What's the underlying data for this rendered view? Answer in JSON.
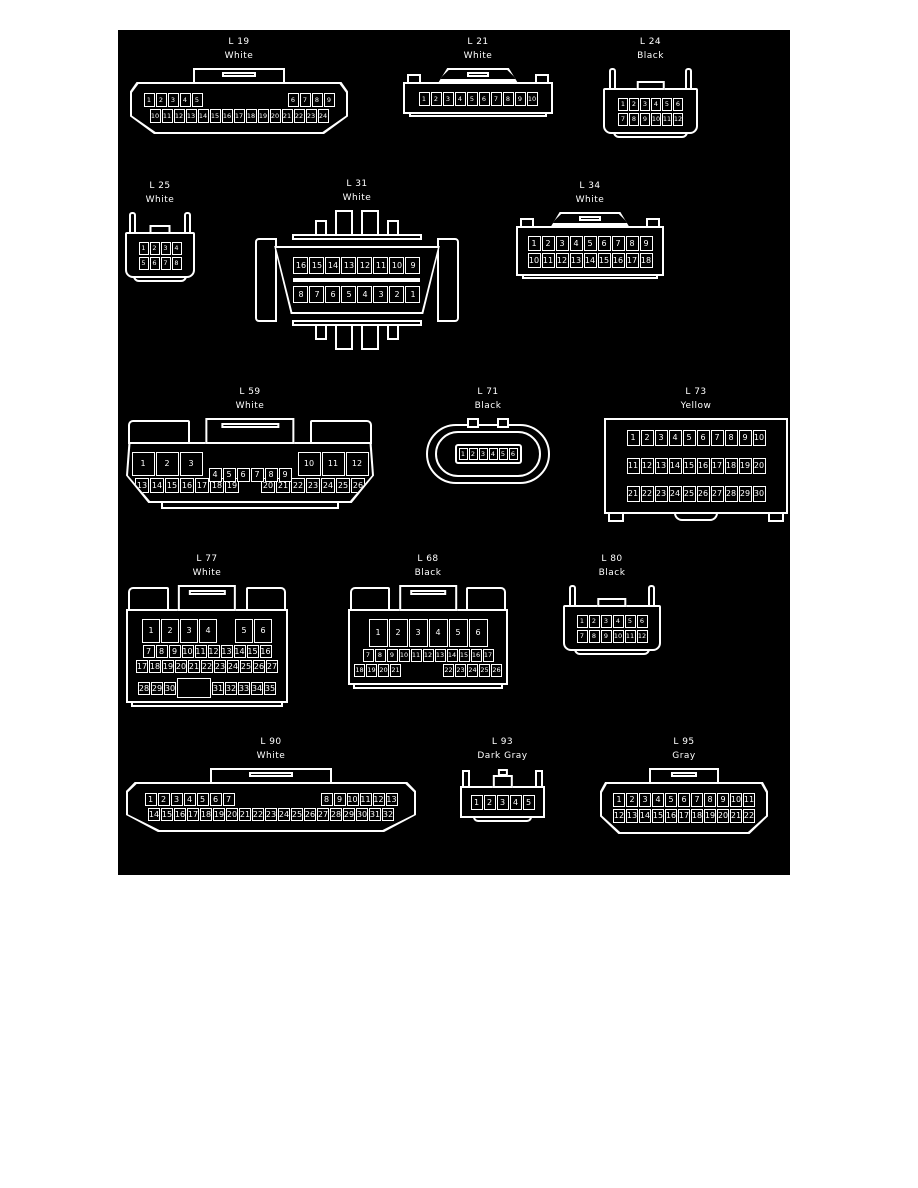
{
  "page": {
    "background": "#ffffff",
    "panel_bg": "#000000",
    "line_color": "#ffffff"
  },
  "connectors": [
    {
      "id": "L 19",
      "color": "White",
      "type": "trap-tab",
      "x": 12,
      "y": 8,
      "w": 218,
      "cell": {
        "w": 11,
        "h": 14
      },
      "rows": [
        {
          "cells": [
            "1",
            "2",
            "3",
            "4",
            "5",
            {
              "gap": 83
            },
            "6",
            "7",
            "8",
            "9"
          ]
        },
        {
          "cells": [
            "10",
            "11",
            "12",
            "13",
            "14",
            "15",
            "16",
            "17",
            "18",
            "19",
            "20",
            "21",
            "22",
            "23",
            "24"
          ]
        }
      ]
    },
    {
      "id": "L 21",
      "color": "White",
      "type": "crown",
      "x": 285,
      "y": 8,
      "w": 150,
      "cell": {
        "w": 11,
        "h": 14
      },
      "rows": [
        {
          "cells": [
            "1",
            "2",
            "3",
            "4",
            "5",
            "6",
            "7",
            "8",
            "9",
            "10"
          ]
        }
      ]
    },
    {
      "id": "L 24",
      "color": "Black",
      "type": "prong",
      "x": 485,
      "y": 8,
      "w": 95,
      "cell": {
        "w": 10,
        "h": 13
      },
      "rows": [
        {
          "cells": [
            "1",
            "2",
            "3",
            "4",
            "5",
            "6"
          ]
        },
        {
          "cells": [
            "7",
            "8",
            "9",
            "10",
            "11",
            "12"
          ]
        }
      ]
    },
    {
      "id": "L 25",
      "color": "White",
      "type": "prong",
      "x": 7,
      "y": 152,
      "w": 70,
      "cell": {
        "w": 10,
        "h": 13
      },
      "rows": [
        {
          "cells": [
            "1",
            "2",
            "3",
            "4"
          ]
        },
        {
          "cells": [
            "5",
            "6",
            "7",
            "8"
          ]
        }
      ]
    },
    {
      "id": "L 31",
      "color": "White",
      "type": "obd",
      "x": 130,
      "y": 150,
      "w": 218,
      "cell": {
        "w": 15,
        "h": 17
      },
      "divider": true,
      "rows": [
        {
          "cells": [
            "16",
            "15",
            "14",
            "13",
            "12",
            "11",
            "10",
            "9"
          ]
        },
        {
          "cells": [
            "8",
            "7",
            "6",
            "5",
            "4",
            "3",
            "2",
            "1"
          ]
        }
      ]
    },
    {
      "id": "L 34",
      "color": "White",
      "type": "crown",
      "x": 398,
      "y": 152,
      "w": 148,
      "cell": {
        "w": 13,
        "h": 15
      },
      "rows": [
        {
          "cells": [
            "1",
            "2",
            "3",
            "4",
            "5",
            "6",
            "7",
            "8",
            "9"
          ]
        },
        {
          "cells": [
            "10",
            "11",
            "12",
            "13",
            "14",
            "15",
            "16",
            "17",
            "18"
          ]
        }
      ]
    },
    {
      "id": "L 59",
      "color": "White",
      "type": "shoulders-trap",
      "x": 8,
      "y": 358,
      "w": 248,
      "cell": {
        "w": 14,
        "h": 15
      },
      "rows": [
        {
          "cells": [
            {
              "n": "1",
              "w": 23,
              "h": 24
            },
            {
              "n": "2",
              "w": 23,
              "h": 24
            },
            {
              "n": "3",
              "w": 23,
              "h": 24
            },
            {
              "gap": 4
            },
            {
              "n": "4",
              "w": 13,
              "h": 14,
              "dy": 6
            },
            {
              "n": "5",
              "w": 13,
              "h": 14,
              "dy": 6
            },
            {
              "n": "6",
              "w": 13,
              "h": 14,
              "dy": 6
            },
            {
              "n": "7",
              "w": 13,
              "h": 14,
              "dy": 6
            },
            {
              "n": "8",
              "w": 13,
              "h": 14,
              "dy": 6
            },
            {
              "n": "9",
              "w": 13,
              "h": 14,
              "dy": 6
            },
            {
              "gap": 4
            },
            {
              "n": "10",
              "w": 23,
              "h": 24
            },
            {
              "n": "11",
              "w": 23,
              "h": 24
            },
            {
              "n": "12",
              "w": 23,
              "h": 24
            }
          ]
        },
        {
          "cells": [
            "13",
            "14",
            "15",
            "16",
            "17",
            "18",
            "19",
            {
              "gap": 20
            },
            "20",
            "21",
            "22",
            "23",
            "24",
            "25",
            "26"
          ]
        }
      ]
    },
    {
      "id": "L 71",
      "color": "Black",
      "type": "oval",
      "x": 308,
      "y": 358,
      "w": 124,
      "cell": {
        "w": 9,
        "h": 12
      },
      "rows": [
        {
          "cells": [
            "1",
            "2",
            "3",
            "4",
            "5",
            "6"
          ]
        }
      ]
    },
    {
      "id": "L 73",
      "color": "Yellow",
      "type": "rect-feet",
      "x": 486,
      "y": 358,
      "w": 184,
      "cell": {
        "w": 13,
        "h": 16
      },
      "row_gap": 12,
      "rows": [
        {
          "cells": [
            "1",
            "2",
            "3",
            "4",
            "5",
            "6",
            "7",
            "8",
            "9",
            "10"
          ]
        },
        {
          "cells": [
            "11",
            "12",
            "13",
            "14",
            "15",
            "16",
            "17",
            "18",
            "19",
            "20"
          ]
        },
        {
          "cells": [
            "21",
            "22",
            "23",
            "24",
            "25",
            "26",
            "27",
            "28",
            "29",
            "30"
          ]
        }
      ]
    },
    {
      "id": "L 77",
      "color": "White",
      "type": "shoulders",
      "x": 8,
      "y": 525,
      "w": 162,
      "cell": {
        "w": 12,
        "h": 13
      },
      "rows": [
        {
          "cells": [
            {
              "n": "1",
              "w": 18,
              "h": 24
            },
            {
              "n": "2",
              "w": 18,
              "h": 24
            },
            {
              "n": "3",
              "w": 18,
              "h": 24
            },
            {
              "n": "4",
              "w": 18,
              "h": 24
            },
            {
              "gap": 16
            },
            {
              "n": "5",
              "w": 18,
              "h": 24
            },
            {
              "n": "6",
              "w": 18,
              "h": 24
            }
          ]
        },
        {
          "cells": [
            "7",
            "8",
            "9",
            "10",
            "11",
            "12",
            "13",
            "14",
            "15",
            "16"
          ]
        },
        {
          "cells": [
            "17",
            "18",
            "19",
            "20",
            "21",
            "22",
            "23",
            "24",
            "25",
            "26",
            "27"
          ]
        },
        {
          "cells": [
            "28",
            "29",
            "30",
            {
              "blank": true,
              "w": 34,
              "h": 20,
              "dy": 3
            },
            "31",
            "32",
            "33",
            "34",
            "35"
          ]
        }
      ]
    },
    {
      "id": "L 68",
      "color": "Black",
      "type": "shoulders",
      "x": 230,
      "y": 525,
      "w": 160,
      "cell": {
        "w": 11,
        "h": 13
      },
      "rows": [
        {
          "cells": [
            {
              "n": "1",
              "w": 19,
              "h": 28
            },
            {
              "n": "2",
              "w": 19,
              "h": 28
            },
            {
              "n": "3",
              "w": 19,
              "h": 28
            },
            {
              "n": "4",
              "w": 19,
              "h": 28
            },
            {
              "n": "5",
              "w": 19,
              "h": 28
            },
            {
              "n": "6",
              "w": 19,
              "h": 28
            }
          ]
        },
        {
          "cells": [
            "7",
            "8",
            "9",
            "10",
            "11",
            "12",
            "13",
            "14",
            "15",
            "16",
            "17"
          ]
        },
        {
          "cells": [
            "18",
            "19",
            "20",
            "21",
            {
              "gap": 40
            },
            "22",
            "23",
            "24",
            "25",
            "26"
          ]
        }
      ]
    },
    {
      "id": "L 80",
      "color": "Black",
      "type": "prong",
      "x": 445,
      "y": 525,
      "w": 98,
      "cell": {
        "w": 11,
        "h": 13
      },
      "rows": [
        {
          "cells": [
            "1",
            "2",
            "3",
            "4",
            "5",
            "6"
          ]
        },
        {
          "cells": [
            "7",
            "8",
            "9",
            "10",
            "11",
            "12"
          ]
        }
      ]
    },
    {
      "id": "L 90",
      "color": "White",
      "type": "trap-tab",
      "x": 8,
      "y": 708,
      "w": 290,
      "cell": {
        "w": 12,
        "h": 13
      },
      "rows": [
        {
          "cells": [
            "1",
            "2",
            "3",
            "4",
            "5",
            "6",
            "7",
            {
              "gap": 84
            },
            "8",
            "9",
            "10",
            "11",
            "12",
            "13"
          ]
        },
        {
          "cells": [
            "14",
            "15",
            "16",
            "17",
            "18",
            "19",
            "20",
            "21",
            "22",
            "23",
            "24",
            "25",
            "26",
            "27",
            "28",
            "29",
            "30",
            "31",
            "32"
          ]
        }
      ]
    },
    {
      "id": "L 93",
      "color": "Dark Gray",
      "type": "small-crown",
      "x": 342,
      "y": 708,
      "w": 85,
      "cell": {
        "w": 12,
        "h": 15
      },
      "rows": [
        {
          "cells": [
            "1",
            "2",
            "3",
            "4",
            "5"
          ]
        }
      ]
    },
    {
      "id": "L 95",
      "color": "Gray",
      "type": "trap-tab",
      "x": 482,
      "y": 708,
      "w": 168,
      "cell": {
        "w": 12,
        "h": 14
      },
      "rows": [
        {
          "cells": [
            "1",
            "2",
            "3",
            "4",
            "5",
            "6",
            "7",
            "8",
            "9",
            "10",
            "11"
          ]
        },
        {
          "cells": [
            "12",
            "13",
            "14",
            "15",
            "16",
            "17",
            "18",
            "19",
            "20",
            "21",
            "22"
          ]
        }
      ]
    }
  ]
}
